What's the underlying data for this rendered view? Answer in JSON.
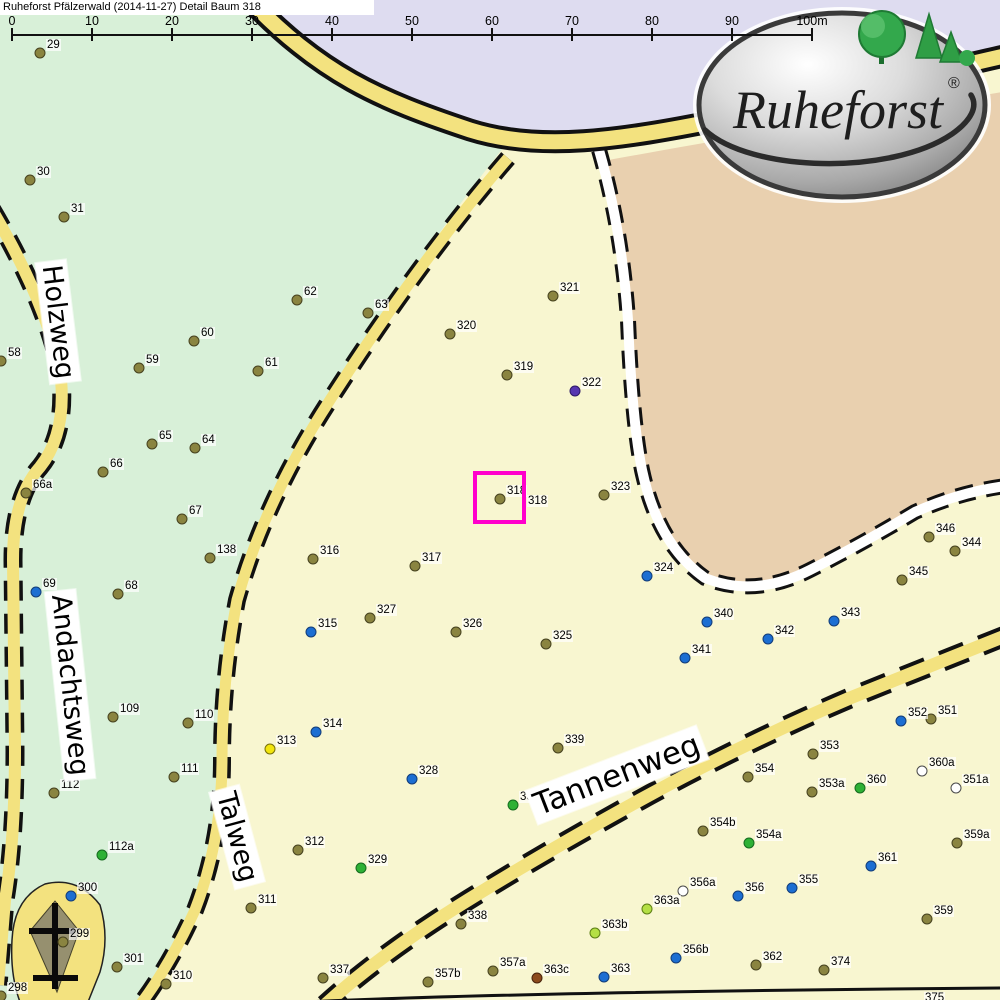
{
  "title": "Ruheforst Pfälzerwald (2014-11-27) Detail  Baum 318",
  "scale_bar": {
    "labels": [
      "0",
      "10",
      "20",
      "30",
      "40",
      "50",
      "60",
      "70",
      "80",
      "90",
      "100m"
    ],
    "start_x": 12,
    "tick_spacing_px": 80
  },
  "logo": {
    "text": "Ruheforst",
    "registered": "®"
  },
  "streets": [
    {
      "name": "Holzweg",
      "x": 58,
      "y": 322,
      "rot": 83,
      "size": 27
    },
    {
      "name": "Andachtsweg",
      "x": 70,
      "y": 685,
      "rot": 84,
      "size": 27
    },
    {
      "name": "Talweg",
      "x": 237,
      "y": 837,
      "rot": 75,
      "size": 27
    },
    {
      "name": "Tannenweg",
      "x": 617,
      "y": 775,
      "rot": -21,
      "size": 31
    }
  ],
  "highlight": {
    "tree": "318",
    "x": 473,
    "y": 471,
    "size": 53,
    "color": "#ff00cc"
  },
  "extra_labels": [
    {
      "text": "318",
      "x": 527,
      "y": 507
    }
  ],
  "colors": {
    "region_green": "#d8f0d8",
    "region_lavender": "#dedcf0",
    "region_yellow": "#f8f6d0",
    "region_tan": "#e9d0af",
    "road_yellow": "#f3e27f",
    "road_white": "#ffffff",
    "road_border": "#111111",
    "highlight": "#ff00cc",
    "monument_gray": "#96906f"
  },
  "dot_palette": {
    "olive": {
      "fill": "#8a8440",
      "edge": "#46421f"
    },
    "blue": {
      "fill": "#1c6ed2",
      "edge": "#123c78"
    },
    "green": {
      "fill": "#2eb135",
      "edge": "#156a1e"
    },
    "lgreen": {
      "fill": "#b4df45",
      "edge": "#5c7e14"
    },
    "yellow": {
      "fill": "#f2e50e",
      "edge": "#77700a"
    },
    "white": {
      "fill": "#ffffff",
      "edge": "#4a4a4a"
    },
    "purple": {
      "fill": "#5636b0",
      "edge": "#2e1a66"
    },
    "brown": {
      "fill": "#8c4a1c",
      "edge": "#48230c"
    }
  },
  "trees": [
    {
      "id": "29",
      "x": 40,
      "y": 53,
      "c": "olive"
    },
    {
      "id": "30",
      "x": 30,
      "y": 180,
      "c": "olive"
    },
    {
      "id": "31",
      "x": 64,
      "y": 217,
      "c": "olive"
    },
    {
      "id": "58",
      "x": 1,
      "y": 361,
      "c": "olive"
    },
    {
      "id": "59",
      "x": 139,
      "y": 368,
      "c": "olive"
    },
    {
      "id": "60",
      "x": 194,
      "y": 341,
      "c": "olive"
    },
    {
      "id": "61",
      "x": 258,
      "y": 371,
      "c": "olive"
    },
    {
      "id": "62",
      "x": 297,
      "y": 300,
      "c": "olive"
    },
    {
      "id": "63",
      "x": 368,
      "y": 313,
      "c": "olive"
    },
    {
      "id": "64",
      "x": 195,
      "y": 448,
      "c": "olive"
    },
    {
      "id": "65",
      "x": 152,
      "y": 444,
      "c": "olive"
    },
    {
      "id": "66",
      "x": 103,
      "y": 472,
      "c": "olive"
    },
    {
      "id": "66a",
      "x": 26,
      "y": 493,
      "c": "olive"
    },
    {
      "id": "67",
      "x": 182,
      "y": 519,
      "c": "olive"
    },
    {
      "id": "68",
      "x": 118,
      "y": 594,
      "c": "olive"
    },
    {
      "id": "69",
      "x": 36,
      "y": 592,
      "c": "blue"
    },
    {
      "id": "109",
      "x": 113,
      "y": 717,
      "c": "olive"
    },
    {
      "id": "110",
      "x": 188,
      "y": 723,
      "c": "olive"
    },
    {
      "id": "111",
      "x": 174,
      "y": 777,
      "c": "olive"
    },
    {
      "id": "112",
      "x": 54,
      "y": 793,
      "c": "olive"
    },
    {
      "id": "112a",
      "x": 102,
      "y": 855,
      "c": "green"
    },
    {
      "id": "138",
      "x": 210,
      "y": 558,
      "c": "olive"
    },
    {
      "id": "298",
      "x": 1,
      "y": 996,
      "c": "olive"
    },
    {
      "id": "299",
      "x": 63,
      "y": 942,
      "c": "olive"
    },
    {
      "id": "300",
      "x": 71,
      "y": 896,
      "c": "blue"
    },
    {
      "id": "301",
      "x": 117,
      "y": 967,
      "c": "olive"
    },
    {
      "id": "310",
      "x": 166,
      "y": 984,
      "c": "olive"
    },
    {
      "id": "311",
      "x": 251,
      "y": 908,
      "c": "olive"
    },
    {
      "id": "312",
      "x": 298,
      "y": 850,
      "c": "olive"
    },
    {
      "id": "313",
      "x": 270,
      "y": 749,
      "c": "yellow"
    },
    {
      "id": "314",
      "x": 316,
      "y": 732,
      "c": "blue"
    },
    {
      "id": "315",
      "x": 311,
      "y": 632,
      "c": "blue"
    },
    {
      "id": "316",
      "x": 313,
      "y": 559,
      "c": "olive"
    },
    {
      "id": "317",
      "x": 415,
      "y": 566,
      "c": "olive"
    },
    {
      "id": "318",
      "x": 500,
      "y": 499,
      "c": "olive"
    },
    {
      "id": "319",
      "x": 507,
      "y": 375,
      "c": "olive"
    },
    {
      "id": "320",
      "x": 450,
      "y": 334,
      "c": "olive"
    },
    {
      "id": "321",
      "x": 553,
      "y": 296,
      "c": "olive"
    },
    {
      "id": "322",
      "x": 575,
      "y": 391,
      "c": "purple"
    },
    {
      "id": "323",
      "x": 604,
      "y": 495,
      "c": "olive"
    },
    {
      "id": "324",
      "x": 647,
      "y": 576,
      "c": "blue"
    },
    {
      "id": "325",
      "x": 546,
      "y": 644,
      "c": "olive"
    },
    {
      "id": "326",
      "x": 456,
      "y": 632,
      "c": "olive"
    },
    {
      "id": "327",
      "x": 370,
      "y": 618,
      "c": "olive"
    },
    {
      "id": "328",
      "x": 412,
      "y": 779,
      "c": "blue"
    },
    {
      "id": "329",
      "x": 361,
      "y": 868,
      "c": "green"
    },
    {
      "id": "337",
      "x": 323,
      "y": 978,
      "c": "olive"
    },
    {
      "id": "338",
      "x": 461,
      "y": 924,
      "c": "olive"
    },
    {
      "id": "339",
      "x": 558,
      "y": 748,
      "c": "olive"
    },
    {
      "id": "339a",
      "x": 513,
      "y": 805,
      "c": "green"
    },
    {
      "id": "340",
      "x": 707,
      "y": 622,
      "c": "blue"
    },
    {
      "id": "341",
      "x": 685,
      "y": 658,
      "c": "blue"
    },
    {
      "id": "342",
      "x": 768,
      "y": 639,
      "c": "blue"
    },
    {
      "id": "343",
      "x": 834,
      "y": 621,
      "c": "blue"
    },
    {
      "id": "344",
      "x": 955,
      "y": 551,
      "c": "olive"
    },
    {
      "id": "345",
      "x": 902,
      "y": 580,
      "c": "olive"
    },
    {
      "id": "346",
      "x": 929,
      "y": 537,
      "c": "olive"
    },
    {
      "id": "351",
      "x": 931,
      "y": 719,
      "c": "olive"
    },
    {
      "id": "351a",
      "x": 956,
      "y": 788,
      "c": "white"
    },
    {
      "id": "352",
      "x": 901,
      "y": 721,
      "c": "blue"
    },
    {
      "id": "353",
      "x": 813,
      "y": 754,
      "c": "olive"
    },
    {
      "id": "353a",
      "x": 812,
      "y": 792,
      "c": "olive"
    },
    {
      "id": "354",
      "x": 748,
      "y": 777,
      "c": "olive"
    },
    {
      "id": "354a",
      "x": 749,
      "y": 843,
      "c": "green"
    },
    {
      "id": "354b",
      "x": 703,
      "y": 831,
      "c": "olive"
    },
    {
      "id": "355",
      "x": 792,
      "y": 888,
      "c": "blue"
    },
    {
      "id": "356",
      "x": 738,
      "y": 896,
      "c": "blue"
    },
    {
      "id": "356a",
      "x": 683,
      "y": 891,
      "c": "white"
    },
    {
      "id": "356b",
      "x": 676,
      "y": 958,
      "c": "blue"
    },
    {
      "id": "357a",
      "x": 493,
      "y": 971,
      "c": "olive"
    },
    {
      "id": "357b",
      "x": 428,
      "y": 982,
      "c": "olive"
    },
    {
      "id": "359",
      "x": 927,
      "y": 919,
      "c": "olive"
    },
    {
      "id": "359a",
      "x": 957,
      "y": 843,
      "c": "olive"
    },
    {
      "id": "360",
      "x": 860,
      "y": 788,
      "c": "green"
    },
    {
      "id": "360a",
      "x": 922,
      "y": 771,
      "c": "white"
    },
    {
      "id": "361",
      "x": 871,
      "y": 866,
      "c": "blue"
    },
    {
      "id": "362",
      "x": 756,
      "y": 965,
      "c": "olive"
    },
    {
      "id": "363",
      "x": 604,
      "y": 977,
      "c": "blue"
    },
    {
      "id": "363a",
      "x": 647,
      "y": 909,
      "c": "lgreen"
    },
    {
      "id": "363b",
      "x": 595,
      "y": 933,
      "c": "lgreen"
    },
    {
      "id": "363c",
      "x": 537,
      "y": 978,
      "c": "brown"
    },
    {
      "id": "374",
      "x": 824,
      "y": 970,
      "c": "olive"
    },
    {
      "id": "375",
      "x": 918,
      "y": 1006,
      "c": "olive"
    }
  ]
}
